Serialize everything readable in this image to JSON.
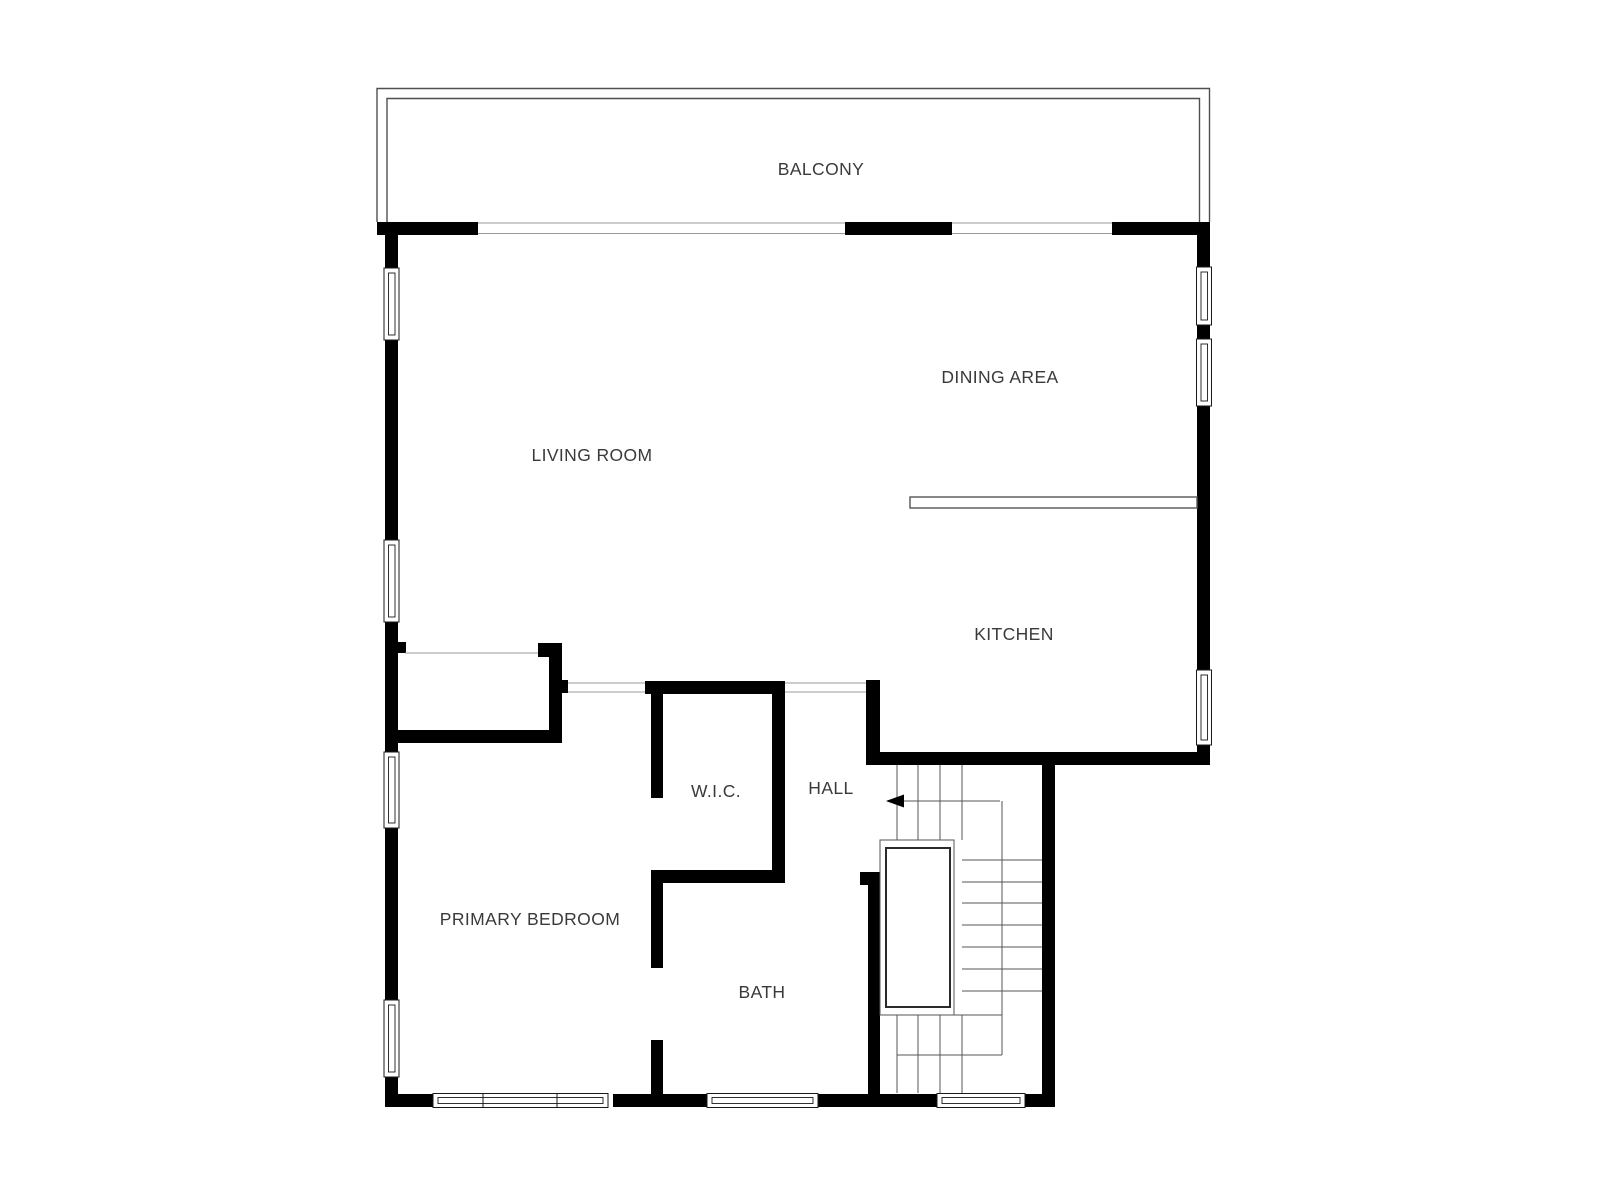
{
  "floor_plan": {
    "rooms": {
      "balcony": "BALCONY",
      "dining_area": "DINING AREA",
      "living_room": "LIVING ROOM",
      "kitchen": "KITCHEN",
      "wic": "W.I.C.",
      "hall": "HALL",
      "primary_bedroom": "PRIMARY BEDROOM",
      "bath": "BATH"
    },
    "colors": {
      "wall": "#000000",
      "background": "#ffffff",
      "label_text": "#3a3a3a",
      "thin_line": "#9a9a9a"
    },
    "stair_direction_arrow": "left"
  }
}
